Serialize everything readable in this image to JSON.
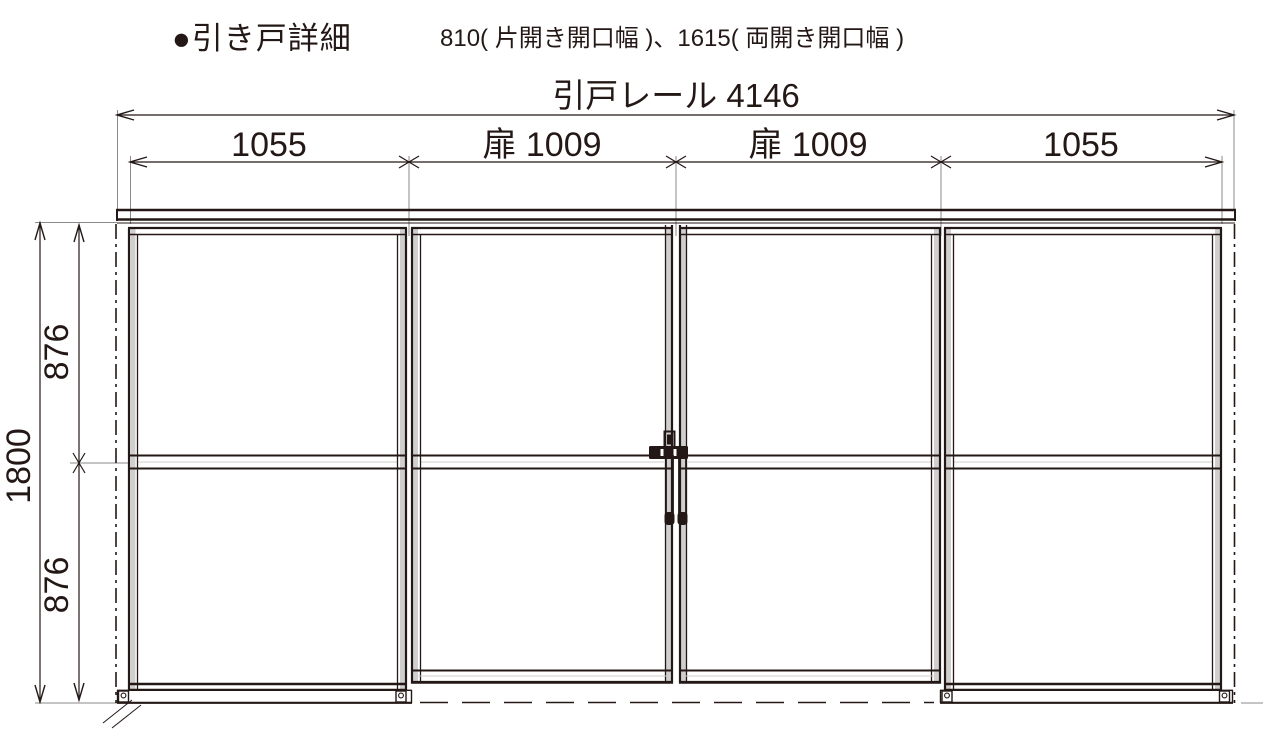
{
  "title": {
    "heading": "●引き戸詳細",
    "note": "810( 片開き開口幅 )、1615( 両開き開口幅 )"
  },
  "dimensions": {
    "rail_label": "引戸レール 4146",
    "segments": [
      "1055",
      "扉 1009",
      "扉 1009",
      "1055"
    ],
    "height_total": "1800",
    "height_upper": "876",
    "height_lower": "876"
  },
  "drawing": {
    "description": "sliding-door elevation, 4 panels: fixed 1055 / door 1009 / door 1009 / fixed 1055",
    "panel_count": 4
  },
  "colors": {
    "ink": "#231815",
    "extension_line": "#8a8a8a",
    "stile_fill": "#cfcfcf",
    "background": "#ffffff"
  }
}
